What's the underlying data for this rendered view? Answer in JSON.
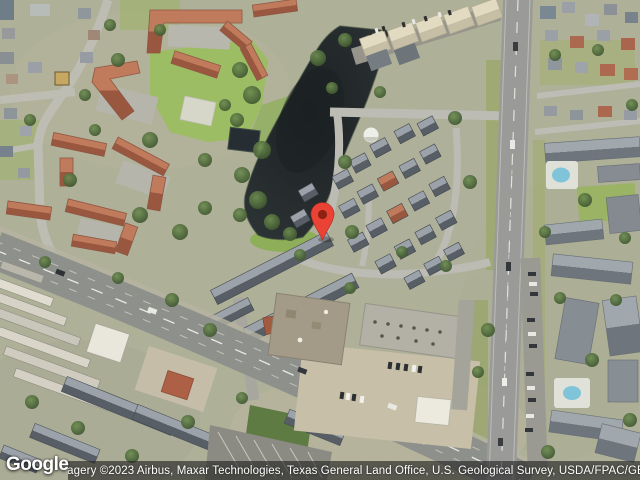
{
  "watermark": {
    "logo_text": "Google"
  },
  "attribution": {
    "text": "Imagery ©2023 Airbus, Maxar Technologies, Texas General Land Office, U.S. Geological Survey, USDA/FPAC/GEO"
  },
  "map": {
    "view_type": "satellite",
    "marker": {
      "icon": "map-pin-icon",
      "color": "#EA4335",
      "inner_color": "#8E2112"
    },
    "palette": {
      "water": "#23282B",
      "lawn": "#9CBD63",
      "roof_red": "#B26E55",
      "roof_gray": "#5B6268",
      "road": "#8F918D",
      "parking": "#C8BFA8"
    }
  }
}
